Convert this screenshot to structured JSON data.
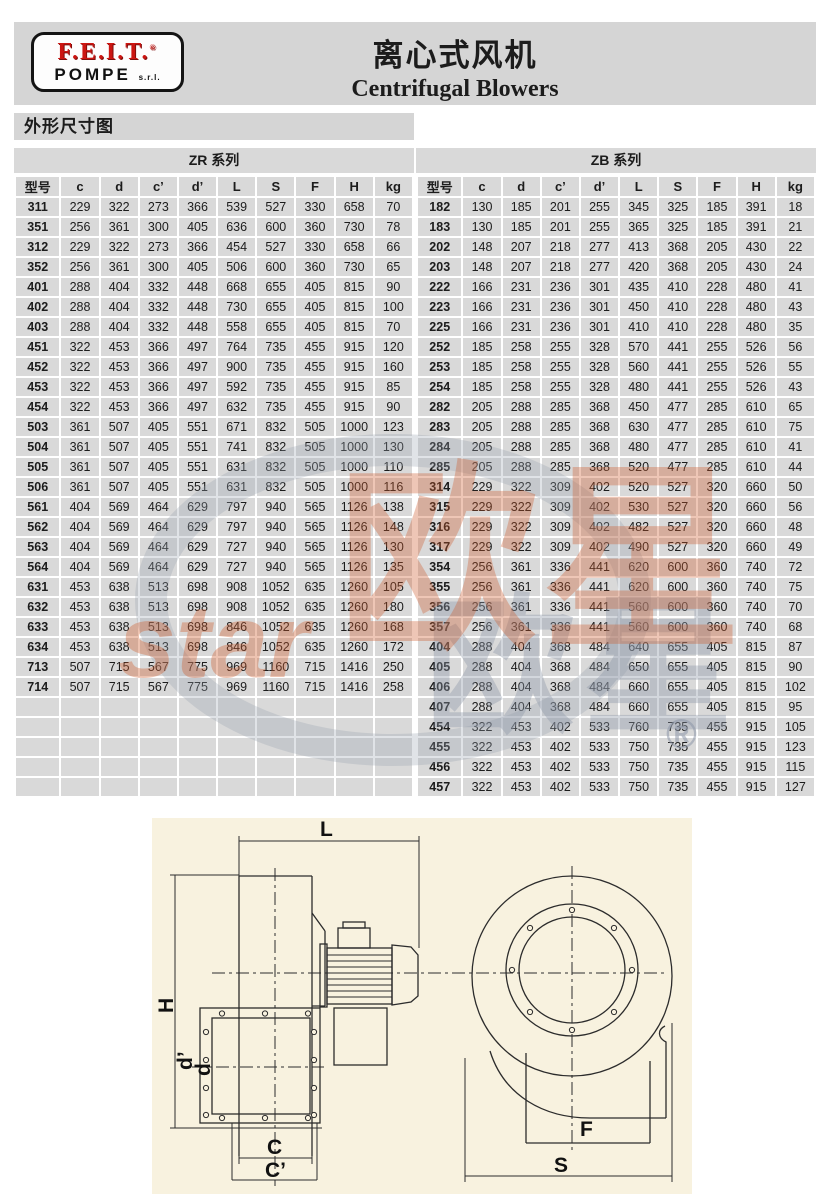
{
  "header": {
    "logo": {
      "line1": "F.E.I.T.",
      "reg": "®",
      "line2": "POMPE",
      "suffix": "s.r.l."
    },
    "title_cn": "离心式风机",
    "title_en": "Centrifugal Blowers"
  },
  "section_label": "外形尺寸图",
  "tables": {
    "zr": {
      "title": "ZR 系列",
      "columns": [
        "型号",
        "c",
        "d",
        "c’",
        "d’",
        "L",
        "S",
        "F",
        "H",
        "kg"
      ],
      "rows": [
        [
          "311",
          229,
          322,
          273,
          366,
          539,
          527,
          330,
          658,
          70
        ],
        [
          "351",
          256,
          361,
          300,
          405,
          636,
          600,
          360,
          730,
          78
        ],
        [
          "312",
          229,
          322,
          273,
          366,
          454,
          527,
          330,
          658,
          66
        ],
        [
          "352",
          256,
          361,
          300,
          405,
          506,
          600,
          360,
          730,
          65
        ],
        [
          "401",
          288,
          404,
          332,
          448,
          668,
          655,
          405,
          815,
          90
        ],
        [
          "402",
          288,
          404,
          332,
          448,
          730,
          655,
          405,
          815,
          100
        ],
        [
          "403",
          288,
          404,
          332,
          448,
          558,
          655,
          405,
          815,
          70
        ],
        [
          "451",
          322,
          453,
          366,
          497,
          764,
          735,
          455,
          915,
          120
        ],
        [
          "452",
          322,
          453,
          366,
          497,
          900,
          735,
          455,
          915,
          160
        ],
        [
          "453",
          322,
          453,
          366,
          497,
          592,
          735,
          455,
          915,
          85
        ],
        [
          "454",
          322,
          453,
          366,
          497,
          632,
          735,
          455,
          915,
          90
        ],
        [
          "503",
          361,
          507,
          405,
          551,
          671,
          832,
          505,
          1000,
          123
        ],
        [
          "504",
          361,
          507,
          405,
          551,
          741,
          832,
          505,
          1000,
          130
        ],
        [
          "505",
          361,
          507,
          405,
          551,
          631,
          832,
          505,
          1000,
          110
        ],
        [
          "506",
          361,
          507,
          405,
          551,
          631,
          832,
          505,
          1000,
          116
        ],
        [
          "561",
          404,
          569,
          464,
          629,
          797,
          940,
          565,
          1126,
          138
        ],
        [
          "562",
          404,
          569,
          464,
          629,
          797,
          940,
          565,
          1126,
          148
        ],
        [
          "563",
          404,
          569,
          464,
          629,
          727,
          940,
          565,
          1126,
          130
        ],
        [
          "564",
          404,
          569,
          464,
          629,
          727,
          940,
          565,
          1126,
          135
        ],
        [
          "631",
          453,
          638,
          513,
          698,
          908,
          1052,
          635,
          1260,
          105
        ],
        [
          "632",
          453,
          638,
          513,
          698,
          908,
          1052,
          635,
          1260,
          180
        ],
        [
          "633",
          453,
          638,
          513,
          698,
          846,
          1052,
          635,
          1260,
          168
        ],
        [
          "634",
          453,
          638,
          513,
          698,
          846,
          1052,
          635,
          1260,
          172
        ],
        [
          "713",
          507,
          715,
          567,
          775,
          969,
          1160,
          715,
          1416,
          250
        ],
        [
          "714",
          507,
          715,
          567,
          775,
          969,
          1160,
          715,
          1416,
          258
        ]
      ],
      "empty_rows": 5
    },
    "zb": {
      "title": "ZB 系列",
      "columns": [
        "型号",
        "c",
        "d",
        "c’",
        "d’",
        "L",
        "S",
        "F",
        "H",
        "kg"
      ],
      "rows": [
        [
          "182",
          130,
          185,
          201,
          255,
          345,
          325,
          185,
          391,
          18
        ],
        [
          "183",
          130,
          185,
          201,
          255,
          365,
          325,
          185,
          391,
          21
        ],
        [
          "202",
          148,
          207,
          218,
          277,
          413,
          368,
          205,
          430,
          22
        ],
        [
          "203",
          148,
          207,
          218,
          277,
          420,
          368,
          205,
          430,
          24
        ],
        [
          "222",
          166,
          231,
          236,
          301,
          435,
          410,
          228,
          480,
          41
        ],
        [
          "223",
          166,
          231,
          236,
          301,
          450,
          410,
          228,
          480,
          43
        ],
        [
          "225",
          166,
          231,
          236,
          301,
          410,
          410,
          228,
          480,
          35
        ],
        [
          "252",
          185,
          258,
          255,
          328,
          570,
          441,
          255,
          526,
          56
        ],
        [
          "253",
          185,
          258,
          255,
          328,
          560,
          441,
          255,
          526,
          55
        ],
        [
          "254",
          185,
          258,
          255,
          328,
          480,
          441,
          255,
          526,
          43
        ],
        [
          "282",
          205,
          288,
          285,
          368,
          450,
          477,
          285,
          610,
          65
        ],
        [
          "283",
          205,
          288,
          285,
          368,
          630,
          477,
          285,
          610,
          75
        ],
        [
          "284",
          205,
          288,
          285,
          368,
          480,
          477,
          285,
          610,
          41
        ],
        [
          "285",
          205,
          288,
          285,
          368,
          520,
          477,
          285,
          610,
          44
        ],
        [
          "314",
          229,
          322,
          309,
          402,
          520,
          527,
          320,
          660,
          50
        ],
        [
          "315",
          229,
          322,
          309,
          402,
          530,
          527,
          320,
          660,
          56
        ],
        [
          "316",
          229,
          322,
          309,
          402,
          482,
          527,
          320,
          660,
          48
        ],
        [
          "317",
          229,
          322,
          309,
          402,
          490,
          527,
          320,
          660,
          49
        ],
        [
          "354",
          256,
          361,
          336,
          441,
          620,
          600,
          360,
          740,
          72
        ],
        [
          "355",
          256,
          361,
          336,
          441,
          620,
          600,
          360,
          740,
          75
        ],
        [
          "356",
          256,
          361,
          336,
          441,
          560,
          600,
          360,
          740,
          70
        ],
        [
          "357",
          256,
          361,
          336,
          441,
          560,
          600,
          360,
          740,
          68
        ],
        [
          "404",
          288,
          404,
          368,
          484,
          640,
          655,
          405,
          815,
          87
        ],
        [
          "405",
          288,
          404,
          368,
          484,
          650,
          655,
          405,
          815,
          90
        ],
        [
          "406",
          288,
          404,
          368,
          484,
          660,
          655,
          405,
          815,
          102
        ],
        [
          "407",
          288,
          404,
          368,
          484,
          660,
          655,
          405,
          815,
          95
        ],
        [
          "454",
          322,
          453,
          402,
          533,
          760,
          735,
          455,
          915,
          105
        ],
        [
          "455",
          322,
          453,
          402,
          533,
          750,
          735,
          455,
          915,
          123
        ],
        [
          "456",
          322,
          453,
          402,
          533,
          750,
          735,
          455,
          915,
          115
        ],
        [
          "457",
          322,
          453,
          402,
          533,
          750,
          735,
          455,
          915,
          127
        ]
      ],
      "empty_rows": 0
    }
  },
  "watermark": {
    "text_cn": "欧星",
    "text_cn_shadow": "欧星",
    "text_en": "star",
    "reg": "®",
    "orange": "#cf5b2b",
    "gray": "#8d97a8"
  },
  "diagram": {
    "labels": {
      "L": "L",
      "H": "H",
      "d_prime": "d’",
      "d": "d",
      "C": "C",
      "C_prime": "C’",
      "F": "F",
      "S": "S"
    }
  }
}
